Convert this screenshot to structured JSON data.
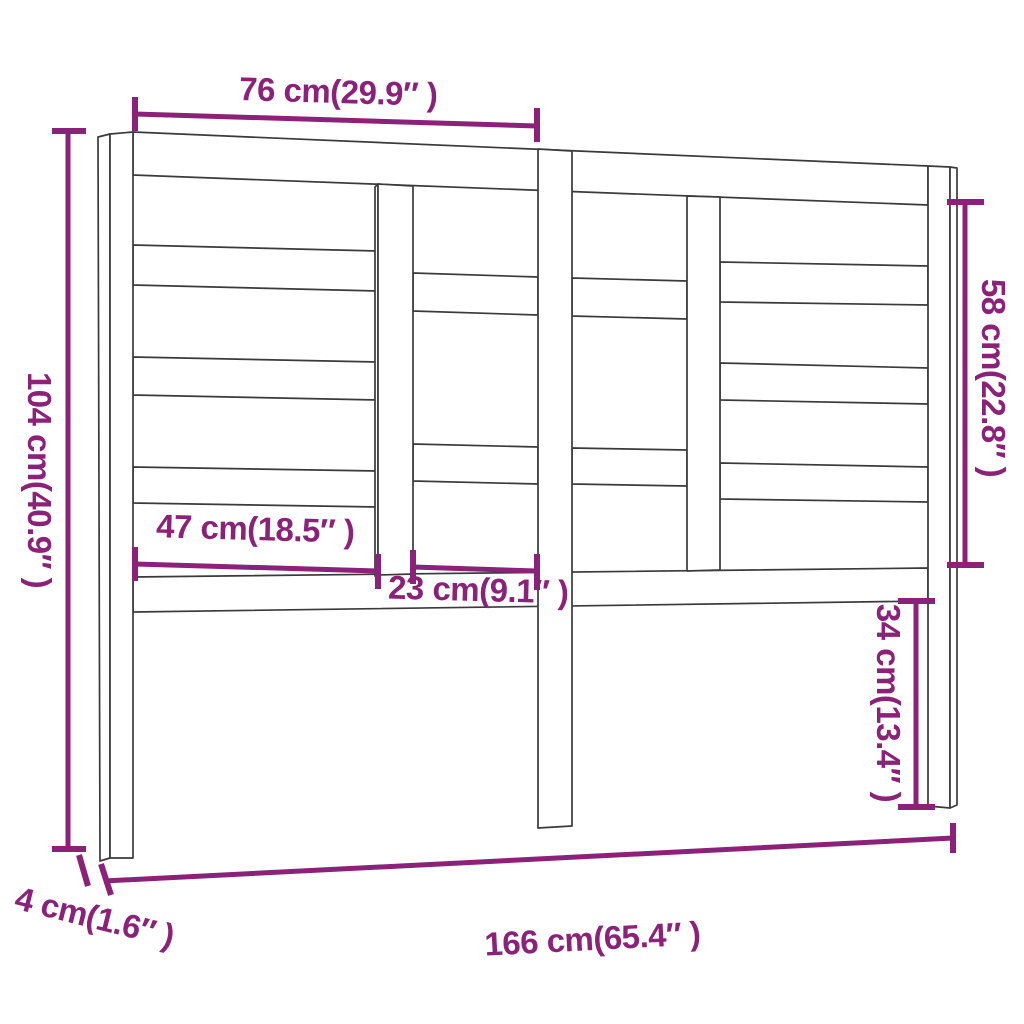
{
  "page": {
    "background": "#ffffff"
  },
  "diagram": {
    "title": "Headboard dimension drawing",
    "accent_color": "#8b2178",
    "outline_color": "#3a3a3a",
    "dimensions": {
      "top_width": {
        "cm": "76",
        "inch": "29.9",
        "label": "76 cm(29.9″ )"
      },
      "left_height": {
        "cm": "104",
        "inch": "40.9",
        "label": "104 cm(40.9″ )"
      },
      "right_upper_height": {
        "cm": "58",
        "inch": "22.8",
        "label": "58 cm(22.8″ )"
      },
      "left_slat_length": {
        "cm": "47",
        "inch": "18.5",
        "label": "47 cm(18.5″ )"
      },
      "center_slat_length": {
        "cm": "23",
        "inch": "9.1",
        "label": "23 cm(9.1″ )"
      },
      "right_lower_height": {
        "cm": "34",
        "inch": "13.4",
        "label": "34 cm(13.4″ )"
      },
      "total_width": {
        "cm": "166",
        "inch": "65.4",
        "label": "166 cm(65.4″ )"
      },
      "post_thickness": {
        "cm": "4",
        "inch": "1.6",
        "label": "4 cm(1.6″ )"
      }
    }
  }
}
